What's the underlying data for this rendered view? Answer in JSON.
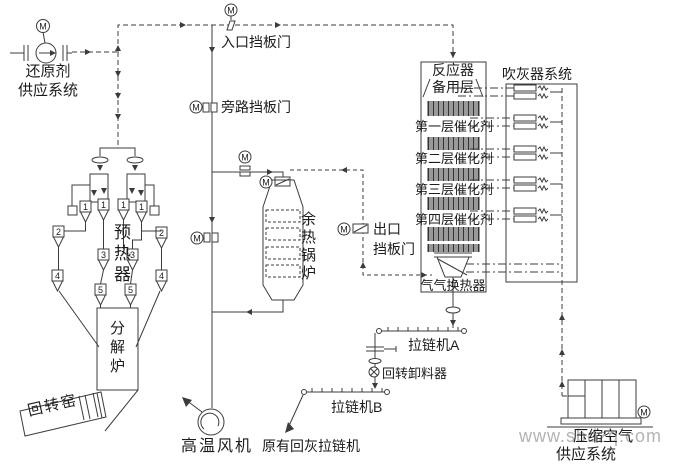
{
  "motor_symbol": "M",
  "colors": {
    "line": "#3c3c3c",
    "text": "#1c1c1c",
    "watermark": "#b4b4b4"
  },
  "supply_system": {
    "line1": "还原剂",
    "line2": "供应系统"
  },
  "dampers": {
    "inlet": "入口挡板门",
    "bypass": "旁路挡板门",
    "outlet_line1": "出口",
    "outlet_line2": "挡板门"
  },
  "preheater": {
    "label": "预热器",
    "cyclone_numbers": [
      "1",
      "1",
      "1",
      "1",
      "2",
      "2",
      "3",
      "3",
      "4",
      "4",
      "5",
      "5"
    ]
  },
  "calciner": {
    "label": "分解炉"
  },
  "kiln": {
    "label": "回转窑"
  },
  "boiler": {
    "label": "余热锅炉"
  },
  "fan": {
    "label": "高温风机"
  },
  "reactor": {
    "title": "反应器",
    "spare_layer": "备用层",
    "layers": [
      "第一层催化剂",
      "第二层催化剂",
      "第三层催化剂",
      "第四层催化剂"
    ],
    "heat_exchanger": "气气换热器"
  },
  "sootblower": {
    "title": "吹灰器系统"
  },
  "conveyors": {
    "a": "拉链机A",
    "rotary_discharger": "回转卸料器",
    "b": "拉链机B",
    "existing": "原有回灰拉链机"
  },
  "compressor": {
    "line1": "压缩空气",
    "line2": "供应系统"
  },
  "watermark": "www.sbdzq.com"
}
